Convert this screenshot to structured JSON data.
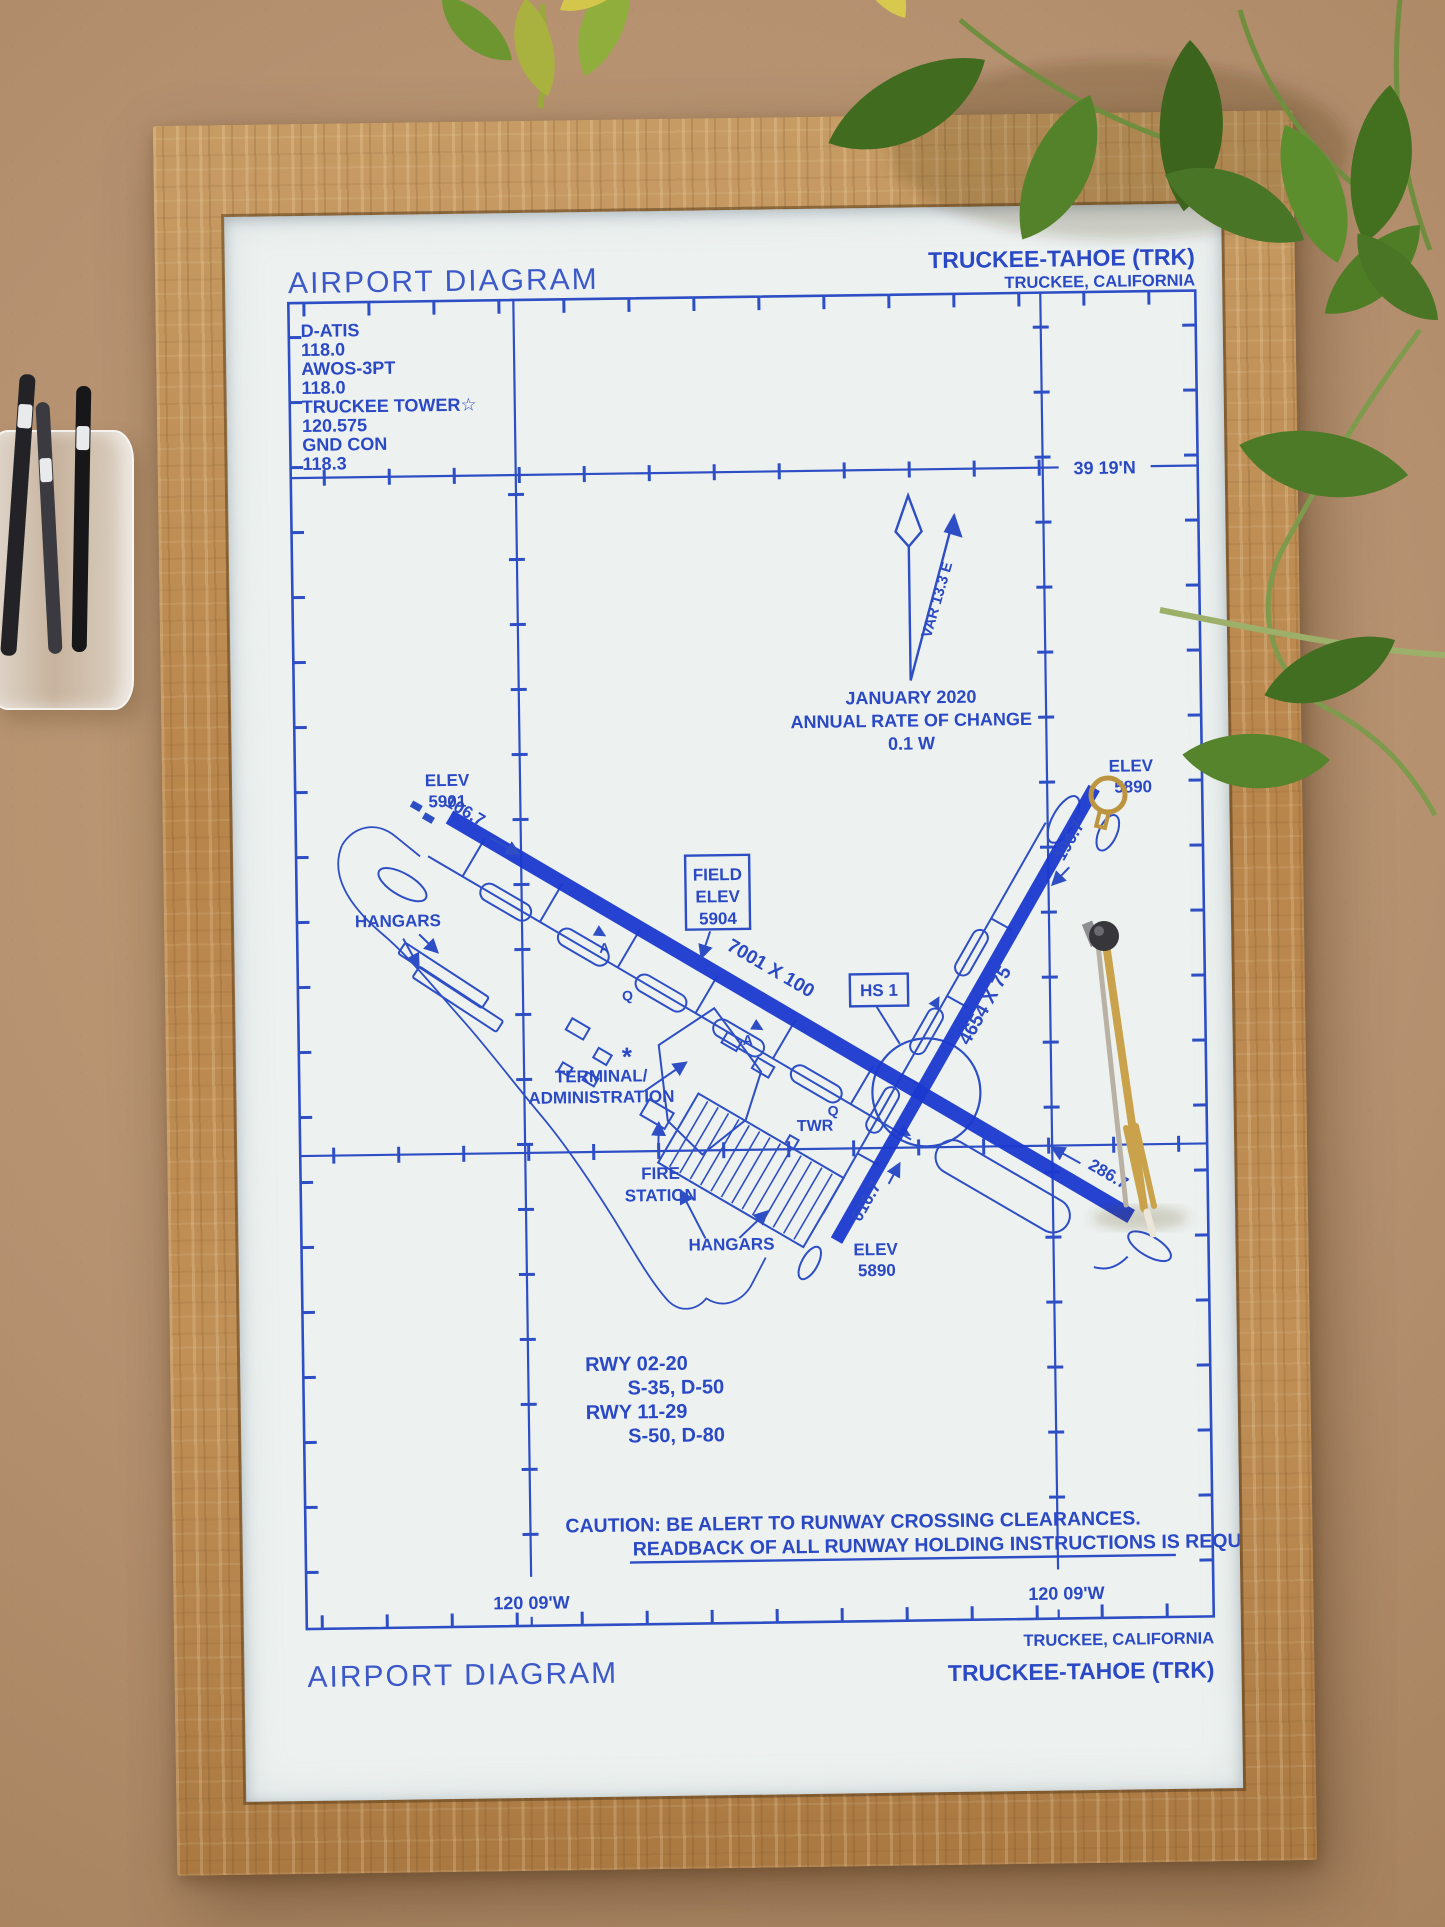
{
  "photo": {
    "colors": {
      "cork_board": "#b59170",
      "oak_frame": "#b9894f",
      "paper": "#edf2f0",
      "ink_blue": "#2b49c5",
      "runway_blue": "#1c39cf",
      "leaf_green": "#4d7a27",
      "brass_tool": "#c9a24b"
    }
  },
  "diagram": {
    "header": {
      "title": "AIRPORT DIAGRAM",
      "airport_name": "TRUCKEE-TAHOE (TRK)",
      "airport_location": "TRUCKEE, CALIFORNIA"
    },
    "comm_box": {
      "lines": [
        "D-ATIS",
        "118.0",
        "AWOS-3PT",
        "118.0",
        "TRUCKEE TOWER☆",
        "120.575",
        "GND CON",
        "118.3"
      ]
    },
    "graticule": {
      "latitude_label": "39 19'N",
      "longitude_label_left": "120 09'W",
      "longitude_label_right": "120 09'W"
    },
    "north": {
      "variation": "VAR 13.3 E",
      "date": "JANUARY 2020",
      "rate_title": "ANNUAL RATE OF CHANGE",
      "rate_value": "0.1  W"
    },
    "field_elev": {
      "l1": "FIELD",
      "l2": "ELEV",
      "l3": "5904"
    },
    "hotspot_label": "HS 1",
    "runway_11_29": {
      "size": "7001 X 100",
      "heading_11": "106.7",
      "heading_29": "286.7",
      "elev_11_l1": "ELEV",
      "elev_11_l2": "5901",
      "elev_29_l1": "ELEV",
      "elev_29_l2": "5890"
    },
    "runway_02_20": {
      "size": "4654 X 75",
      "heading_02": "016.7",
      "heading_20": "196.7°",
      "elev_02_l1": "ELEV",
      "elev_02_l2": "5890"
    },
    "facilities": {
      "hangars_left": "HANGARS",
      "hangars_bottom": "HANGARS",
      "terminal_l1": "TERMINAL/",
      "terminal_l2": "ADMINISTRATION",
      "fire_l1": "FIRE",
      "fire_l2": "STATION",
      "tower": "TWR",
      "helipad_mark": "*",
      "taxiway_a1": "A",
      "taxiway_q1": "Q",
      "taxiway_a2": "A",
      "taxiway_q2": "Q"
    },
    "runway_data": {
      "l1": "RWY 02-20",
      "l2": "S-35, D-50",
      "l3": "RWY 11-29",
      "l4": "S-50, D-80"
    },
    "caution": {
      "l1": "CAUTION: BE ALERT TO RUNWAY CROSSING CLEARANCES.",
      "l2": "READBACK OF ALL RUNWAY HOLDING INSTRUCTIONS IS REQUIRED."
    },
    "footer": {
      "airport_location": "TRUCKEE, CALIFORNIA",
      "airport_name": "TRUCKEE-TAHOE (TRK)",
      "title": "AIRPORT DIAGRAM"
    }
  }
}
